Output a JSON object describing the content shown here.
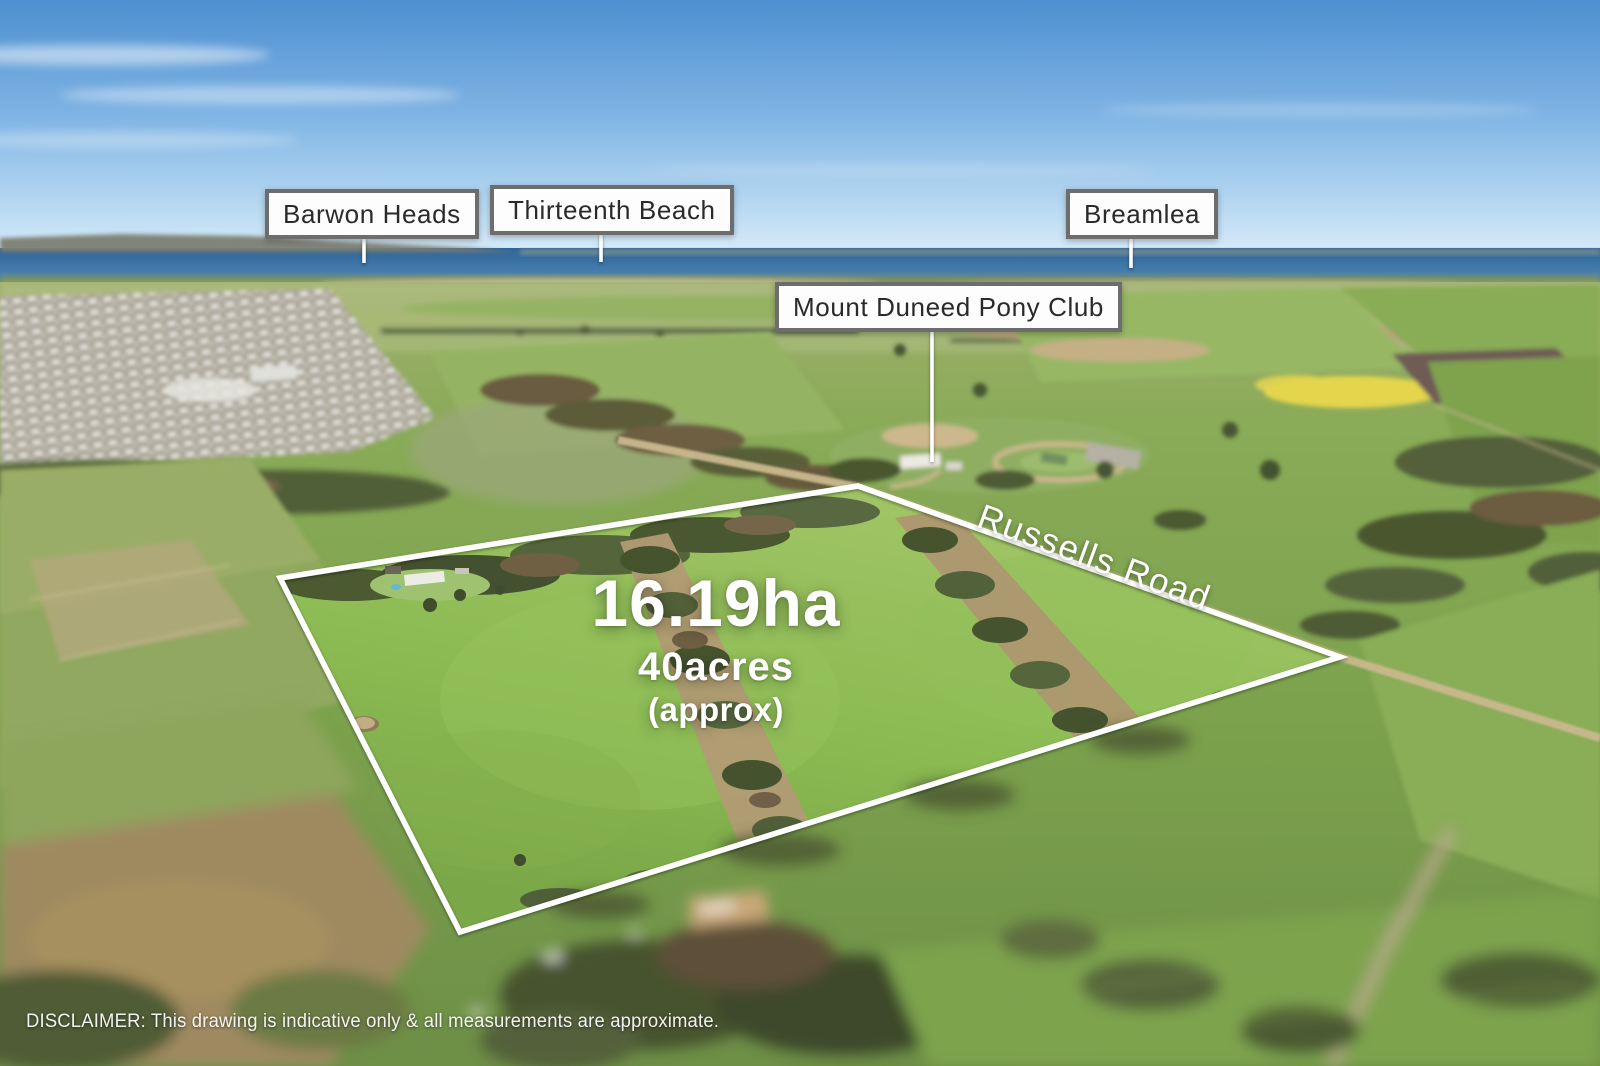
{
  "location_labels": [
    {
      "text": "Barwon Heads"
    },
    {
      "text": "Thirteenth Beach"
    },
    {
      "text": "Breamlea"
    },
    {
      "text": "Mount Duneed Pony Club"
    }
  ],
  "road_label": "Russells Road",
  "area": {
    "hectares": "16.19ha",
    "acres": "40acres",
    "qualifier": "(approx)"
  },
  "disclaimer": "DISCLAIMER: This drawing is indicative only & all measurements are approximate.",
  "colors": {
    "boundary": "#ffffff",
    "leader_line": "#ffffff",
    "label_background": "#fdfdfd",
    "label_border": "#6d6d6d",
    "label_text": "#2a2a2a",
    "overlay_text": "#ffffff",
    "sky_top": "#4d8fd0",
    "sky_horizon": "#d9ecf9",
    "ocean": "#2c6398",
    "property_green": "#8cbb53",
    "canola_yellow": "#e4d54e"
  }
}
